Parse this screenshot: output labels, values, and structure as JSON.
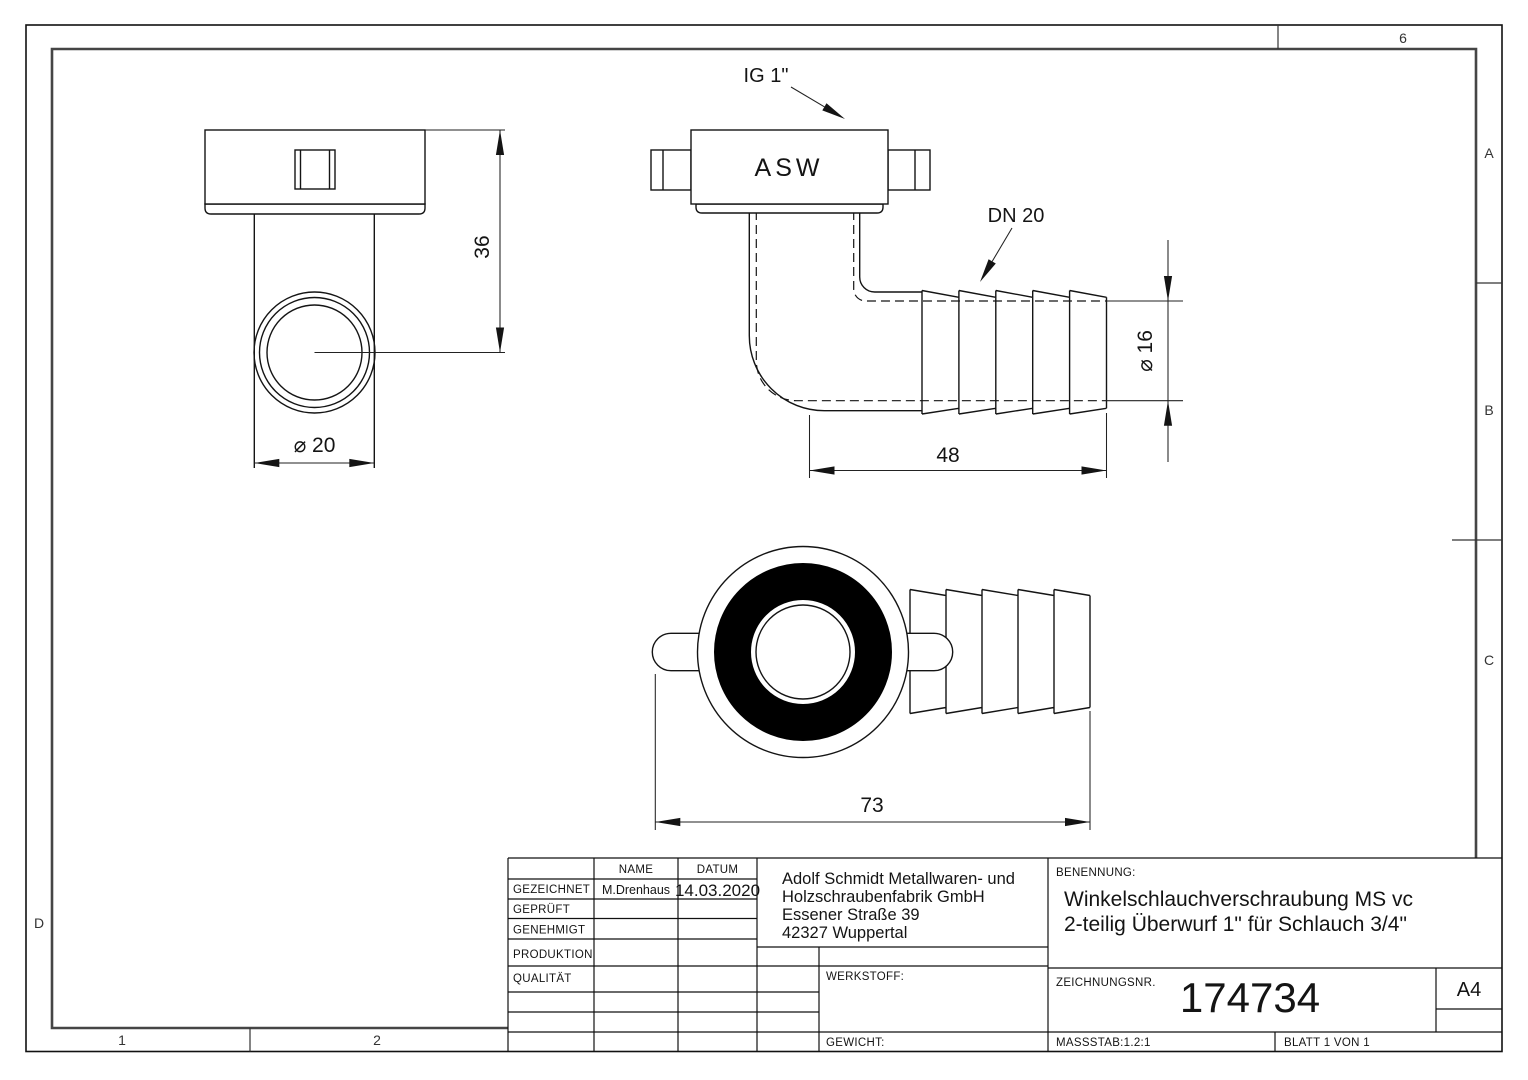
{
  "views": {
    "front": {
      "dim_height": "36",
      "dim_diameter": "⌀ 20"
    },
    "side": {
      "label_thread": "IG 1\"",
      "label_body": "ASW",
      "label_nominal": "DN 20",
      "dim_barb_length": "48",
      "dim_bore": "⌀ 16"
    },
    "bottom": {
      "dim_overall": "73"
    }
  },
  "zones": {
    "col_top": "6",
    "rows_right": [
      "A",
      "B",
      "C"
    ],
    "row_left": "D",
    "cols_bottom": [
      "1",
      "2"
    ]
  },
  "title_block": {
    "rows": [
      "GEZEICHNET",
      "GEPRÜFT",
      "GENEHMIGT",
      "PRODUKTION",
      "QUALITÄT"
    ],
    "name_header": "NAME",
    "date_header": "DATUM",
    "drawn_by": "M.Drenhaus",
    "drawn_date": "14.03.2020",
    "company": [
      "Adolf Schmidt Metallwaren- und",
      "Holzschraubenfabrik GmbH",
      "Essener Straße 39",
      "42327 Wuppertal"
    ],
    "benennung_label": "BENENNUNG:",
    "title_line1": "Winkelschlauchverschraubung MS vc",
    "title_line2": "2-teilig Überwurf 1\" für Schlauch 3/4\"",
    "werkstoff_label": "WERKSTOFF:",
    "gewicht_label": "GEWICHT:",
    "zeichnungsnr_label": "ZEICHNUNGSNR.",
    "drawing_number": "174734",
    "format": "A4",
    "massstab": "MASSSTAB:1.2:1",
    "blatt": "BLATT 1 VON 1"
  }
}
